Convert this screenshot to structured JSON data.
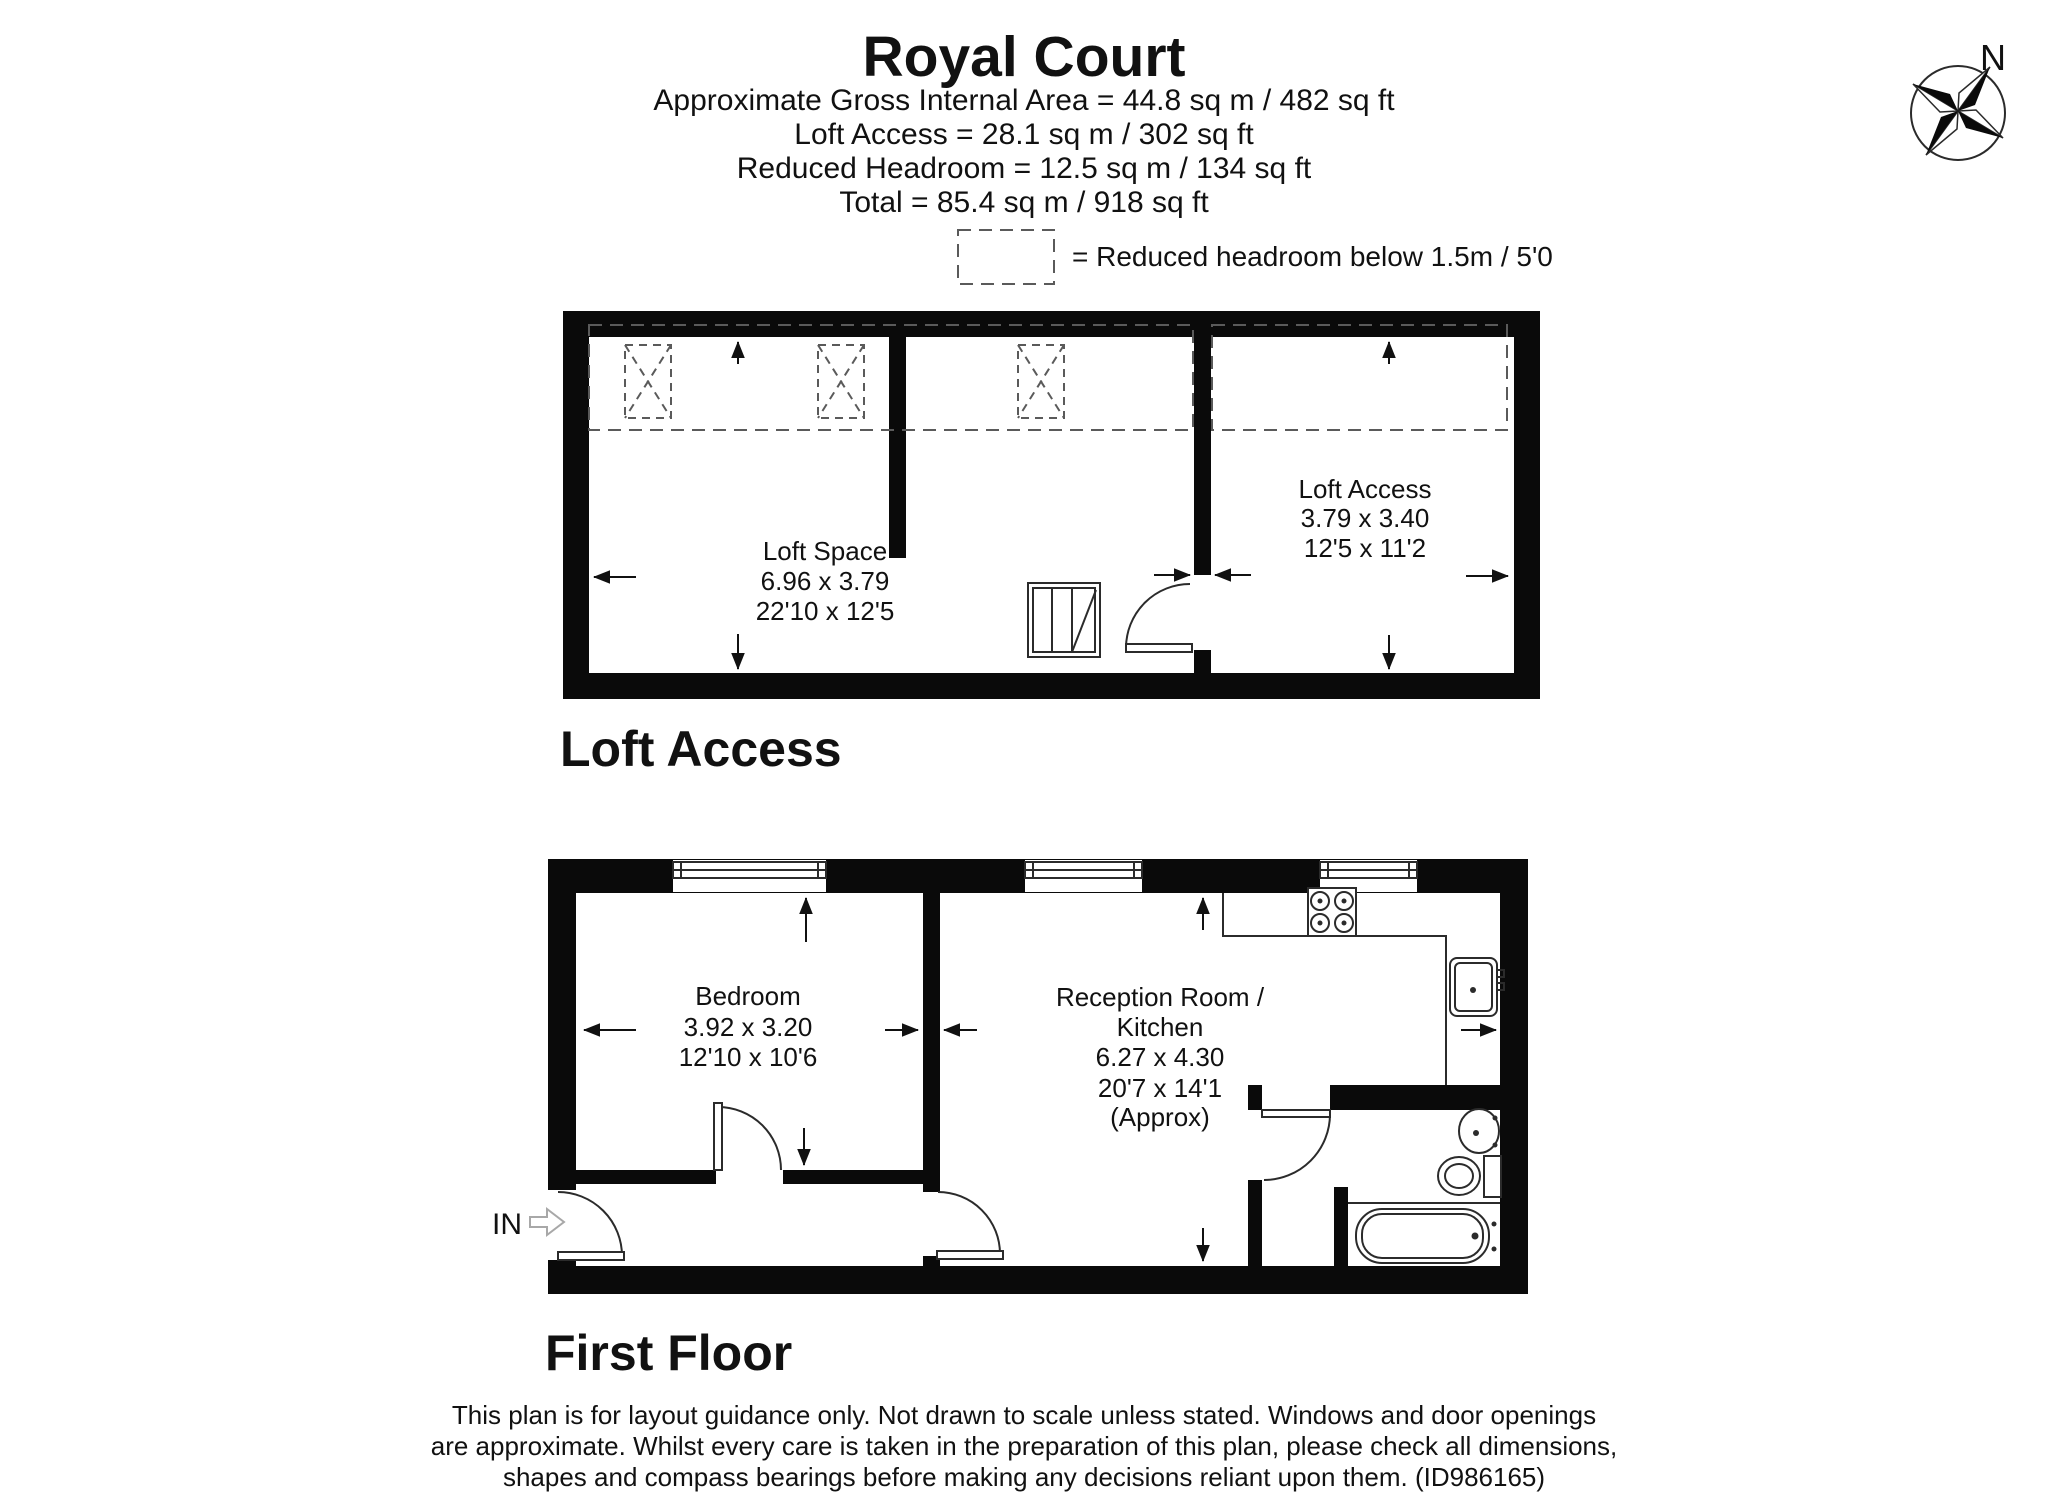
{
  "header": {
    "title": "Royal Court",
    "area_lines": [
      "Approximate Gross Internal Area = 44.8 sq m / 482 sq ft",
      "Loft Access = 28.1 sq m / 302 sq ft",
      "Reduced Headroom = 12.5 sq m / 134 sq ft",
      "Total = 85.4 sq m / 918 sq ft"
    ]
  },
  "legend": {
    "text": "= Reduced headroom below 1.5m / 5'0"
  },
  "compass": {
    "north_label": "N"
  },
  "loft_plan": {
    "section_label": "Loft Access",
    "loft_space": {
      "name": "Loft Space",
      "metric": "6.96 x 3.79",
      "imperial": "22'10 x 12'5"
    },
    "loft_access": {
      "name": "Loft Access",
      "metric": "3.79 x 3.40",
      "imperial": "12'5 x 11'2"
    }
  },
  "first_floor": {
    "section_label": "First Floor",
    "entrance_label": "IN",
    "bedroom": {
      "name": "Bedroom",
      "metric": "3.92 x 3.20",
      "imperial": "12'10 x 10'6"
    },
    "reception": {
      "name_line1": "Reception Room /",
      "name_line2": "Kitchen",
      "metric": "6.27 x 4.30",
      "imperial": "20'7 x 14'1",
      "qualifier": "(Approx)"
    }
  },
  "disclaimer": {
    "lines": [
      "This plan is for layout guidance only. Not drawn to scale unless stated. Windows and door openings",
      "are approximate. Whilst every care is taken in the preparation of this plan, please check all dimensions,",
      "shapes and compass bearings before making any decisions reliant upon them. (ID986165)"
    ]
  },
  "colors": {
    "wall": "#0a0a0a",
    "background": "#ffffff",
    "line": "#2b2b2b"
  }
}
